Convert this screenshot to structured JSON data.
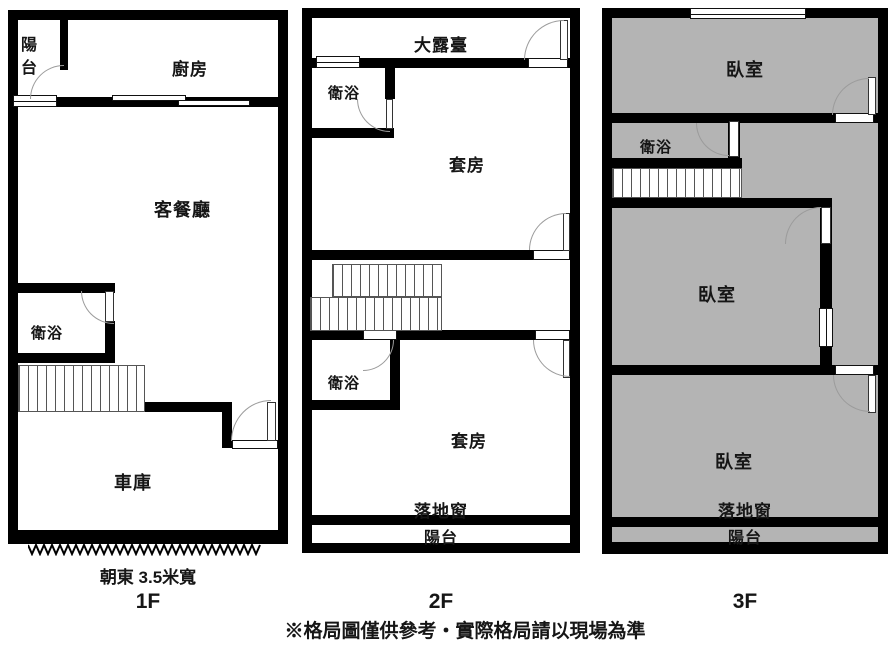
{
  "page": {
    "disclaimer": "※格局圖僅供參考‧實際格局請以現場為準",
    "background": "#ffffff"
  },
  "colors": {
    "wall": "#000000",
    "room_fill_3f": "#b4b4b4",
    "door_arc": "#9b9b9b"
  },
  "floors": [
    {
      "id": "1F",
      "label": "1F",
      "note": "朝東 3.5米寬",
      "rooms": {
        "balcony": "陽台",
        "kitchen": "廚房",
        "living_dining": "客餐廳",
        "bathroom": "衛浴",
        "garage": "車庫"
      }
    },
    {
      "id": "2F",
      "label": "2F",
      "rooms": {
        "terrace": "大露臺",
        "bathroom_upper": "衛浴",
        "suite_upper": "套房",
        "bathroom_lower": "衛浴",
        "suite_lower": "套房",
        "french_window": "落地窗",
        "balcony": "陽台"
      }
    },
    {
      "id": "3F",
      "label": "3F",
      "rooms": {
        "bedroom_top": "臥室",
        "bathroom": "衛浴",
        "bedroom_middle": "臥室",
        "bedroom_bottom": "臥室",
        "french_window": "落地窗",
        "balcony": "陽台"
      }
    }
  ]
}
